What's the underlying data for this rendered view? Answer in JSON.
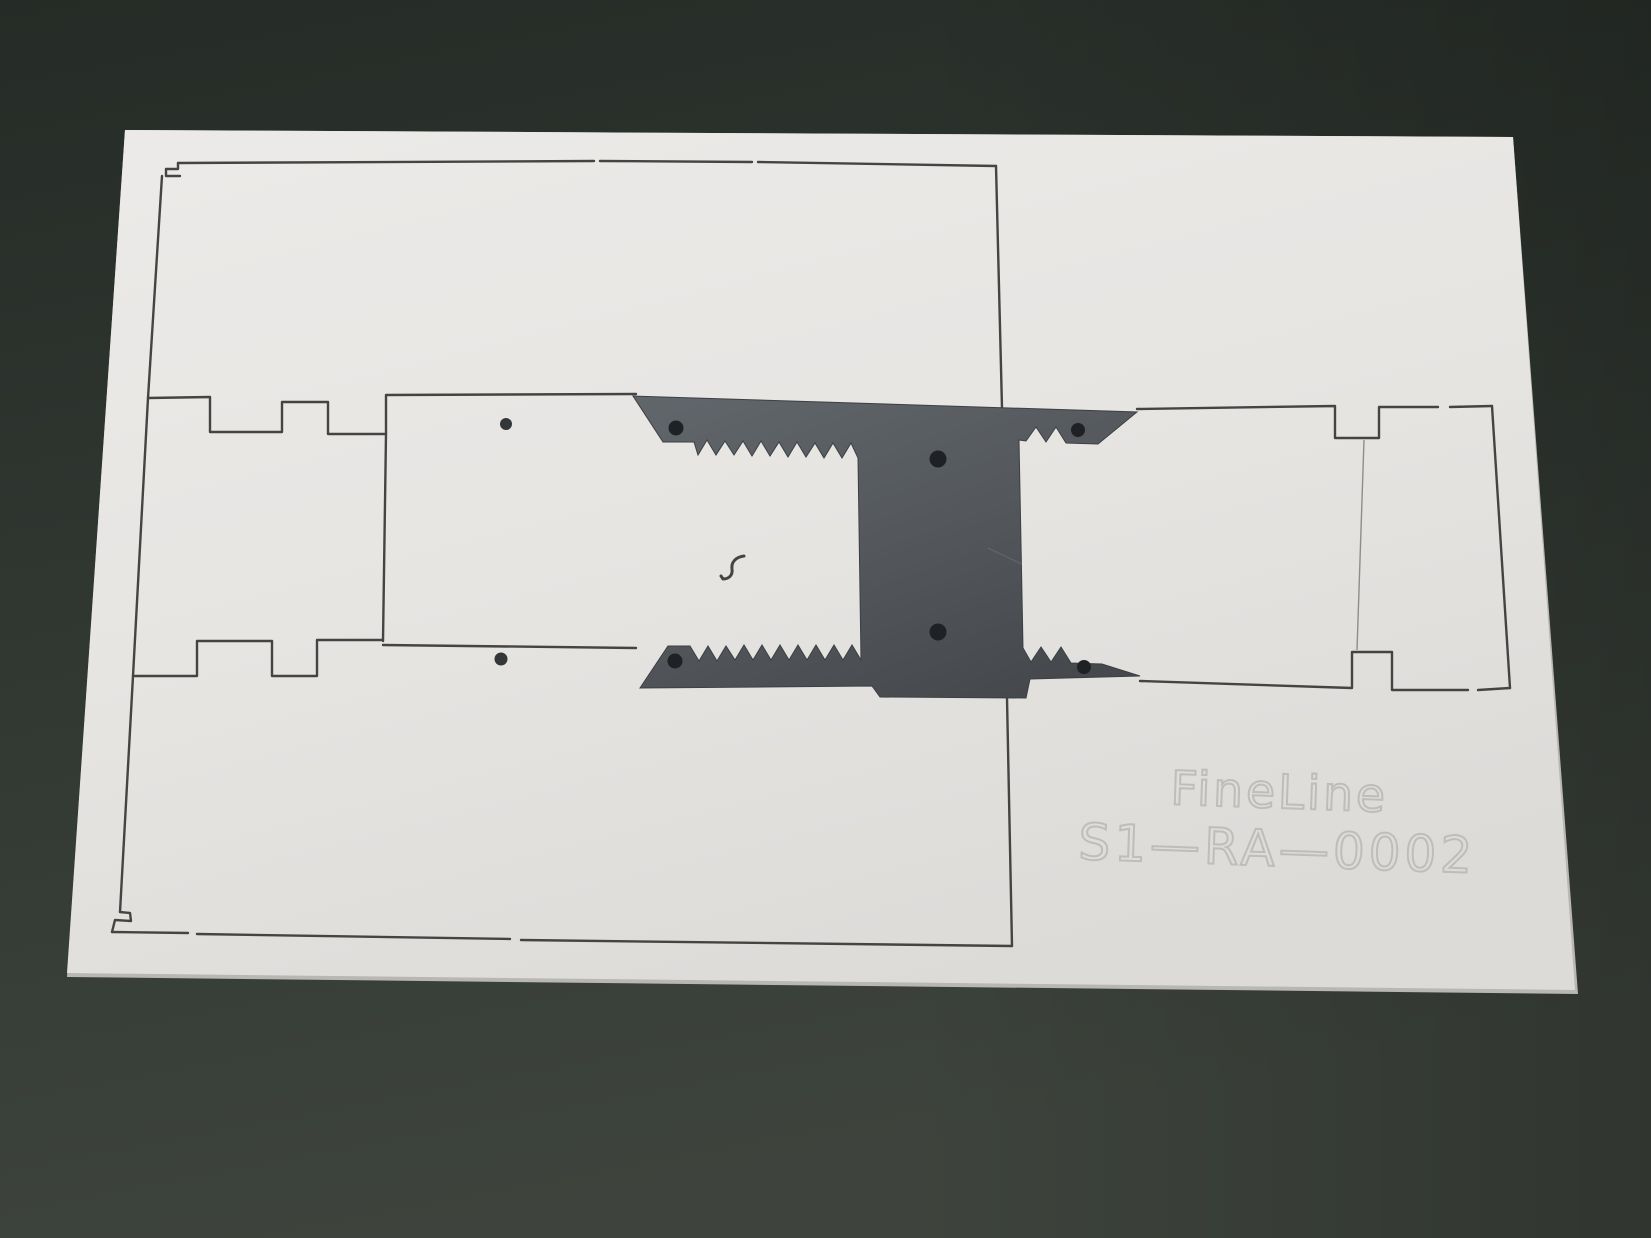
{
  "engraving": {
    "line1": "FineLine",
    "line2": "S1—RA—0002"
  },
  "colors": {
    "table_surface": "#2f3631",
    "table_surface_light": "#3e453e",
    "panel": "#e7e5e2",
    "panel_highlight": "#edebe8",
    "panel_shade": "#dcdad7",
    "panel_edge": "#c9c7c4",
    "cut_line": "#454442",
    "bracket": "#5d6266",
    "bracket_dark": "#46494d",
    "bracket_hole": "#1f2224",
    "panel_hole": "#34373a",
    "engraving_stroke": "#bfbdba",
    "divider_line": "#8d8d8a"
  }
}
